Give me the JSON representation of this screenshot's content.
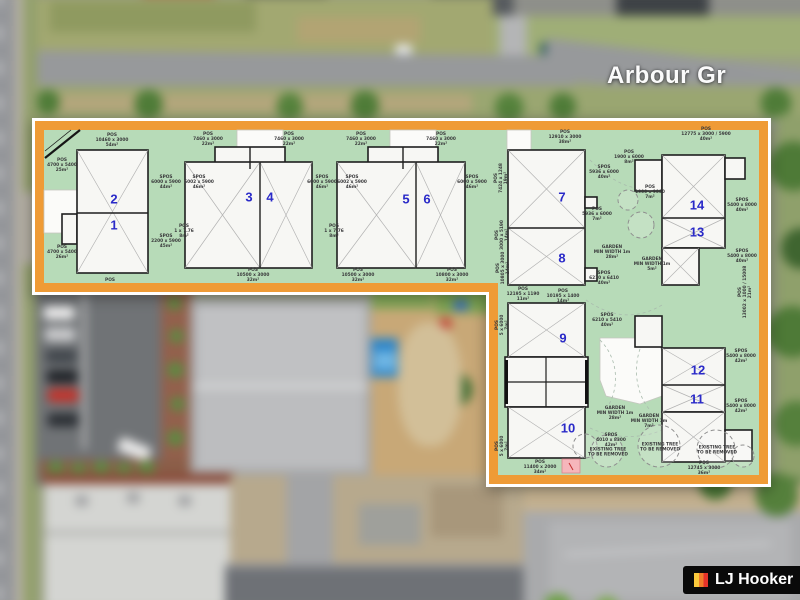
{
  "street_label": "Arbour Gr",
  "branding": {
    "agency": "LJ Hooker"
  },
  "plan": {
    "unit_numbers": [
      "1",
      "2",
      "3",
      "4",
      "5",
      "6",
      "7",
      "8",
      "9",
      "10",
      "11",
      "12",
      "13",
      "14"
    ],
    "labels": [
      "POS\n10460 x 3000\n54m²",
      "POS\n4700 x 5400\n25m²",
      "POS\n4700 x 5400\n26m²",
      "POS",
      "SPOS\n6000 x 5900\n44m²",
      "SPOS\n2200 x 5900\n45m²",
      "POS\n7460 x 3000\n22m²",
      "POS\n7460 x 3000\n22m²",
      "SPOS\n6002 x 5900\n46m²",
      "SPOS\n6000 x 5900\n46m²",
      "POS\n1 x 7.76\n8m²",
      "POS\n10500 x 3000\n32m²",
      "POS\n10500 x 3000\n32m²",
      "POS\n7460 x 3000\n22m²",
      "POS\n7460 x 3000\n22m²",
      "SPOS\n6002 x 5900\n46m²",
      "SPOS\n6000 x 5900\n46m²",
      "POS\n1 x 7.76\n8m²",
      "POS\n10800 x 3000\n32m²",
      "POS\n12910 x 3000\n38m²",
      "POS\n7424 x 1248\n19m²",
      "SPOS\n5936 x 6000\n40m²",
      "POS\n1900 x 6000\n8m²",
      "POS\n5936 x 6000\n7m²",
      "GARDEN\nMIN WIDTH 1m\n28m²",
      "SPOS\n6210 x 6410\n40m²",
      "POS\n3000 x 5190\n14m²",
      "POS\n10805 x 3000\n14m²",
      "POS\n12195 x 1190\n11m²",
      "POS\n10195 x 1400\n14m²",
      "SPOS\n6210 x 5410\n40m²",
      "POS\n5 x 6000\n7m²",
      "GARDEN\nMIN WIDTH 1m\n28m²",
      "SPOS\n4010 x 8300\n42m²",
      "POS\n5 x 6000\n7m²",
      "POS\n11400 x 2000\n34m²",
      "POS\n12775 x 3000 / 5900\n40m²",
      "POS\n1900 x 9000\n7m²",
      "SPOS\n5400 x 8000\n40m²",
      "SPOS\n5400 x 8000\n40m²",
      "GARDEN\nMIN WIDTH 1m\n5m²",
      "POS\n13002 x 1000 / 15008\n21m²",
      "SPOS\n5400 x 8000\n42m²",
      "SPOS\n5400 x 8000\n42m²",
      "GARDEN\nMIN WIDTH 1m\n7m²",
      "POS\n12745 x 3000\n36m²",
      "EXISTING TREE\nTO BE REMOVED",
      "EXISTING TREE\nTO BE REMOVED",
      "EXISTING TREE\nTO BE REMOVED"
    ],
    "colors": {
      "border_orange": "#EF9B36",
      "pos_green": "#B7DBB8",
      "unit_number_blue": "#2A2AC8",
      "visitor_pink": "#F6B6BB",
      "logo_black": "#0A0A0A"
    }
  }
}
